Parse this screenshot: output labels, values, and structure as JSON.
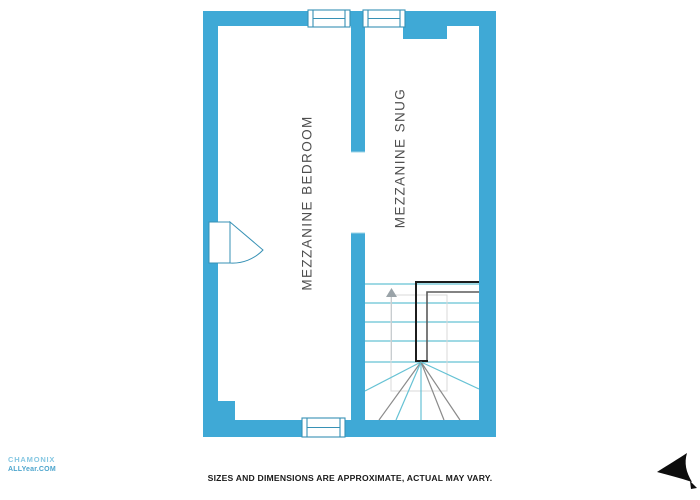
{
  "colors": {
    "wall": "#3fa9d6",
    "window_stroke": "#3791b5",
    "tread": "#66c2d4",
    "rail_dark": "#1c1c1c",
    "rail_mid": "#5a5a5a",
    "winder_gray": "#8a8a8a",
    "void_outline": "#d8d8d8",
    "arrow_gray": "#9aa3a8",
    "room_label": "#4f4f4f",
    "disclaimer": "#1a1a1a",
    "watermark_light": "#85c7e2",
    "watermark_mid": "#4da5cd",
    "cursor": "#0d0d0d"
  },
  "plan": {
    "room_labels": [
      {
        "name": "bedroom",
        "label": "MEZZANINE BEDROOM"
      },
      {
        "name": "snug",
        "label": "MEZZANINE SNUG"
      }
    ],
    "stair": {
      "direction": "up"
    }
  },
  "footer": {
    "disclaimer": "SIZES AND DIMENSIONS ARE APPROXIMATE, ACTUAL MAY VARY."
  },
  "watermark": {
    "line1": "CHAMONIX",
    "line2": "ALLYear.COM"
  }
}
